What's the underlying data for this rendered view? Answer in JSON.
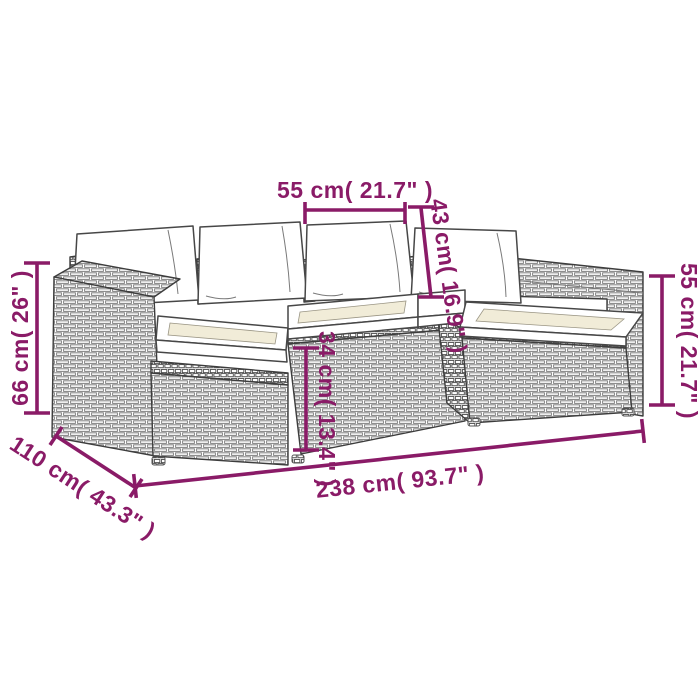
{
  "page": {
    "background_color": "#ffffff",
    "accent_color": "#8a1b67"
  },
  "diagram": {
    "subject": "rattan garden lounge sofa set with ottoman and white cushions",
    "dimensions": {
      "seat_width": "55 cm( 21.7\" )",
      "back_cushion_height": "43 cm( 16.9\" )",
      "total_height": "66 cm( 26\" )",
      "seat_base_height": "34 cm( 13.4\" )",
      "armrest_height": "55 cm( 21.7\" )",
      "total_width": "238 cm( 93.7\" )",
      "depth": "110 cm( 43.3\" )"
    }
  }
}
